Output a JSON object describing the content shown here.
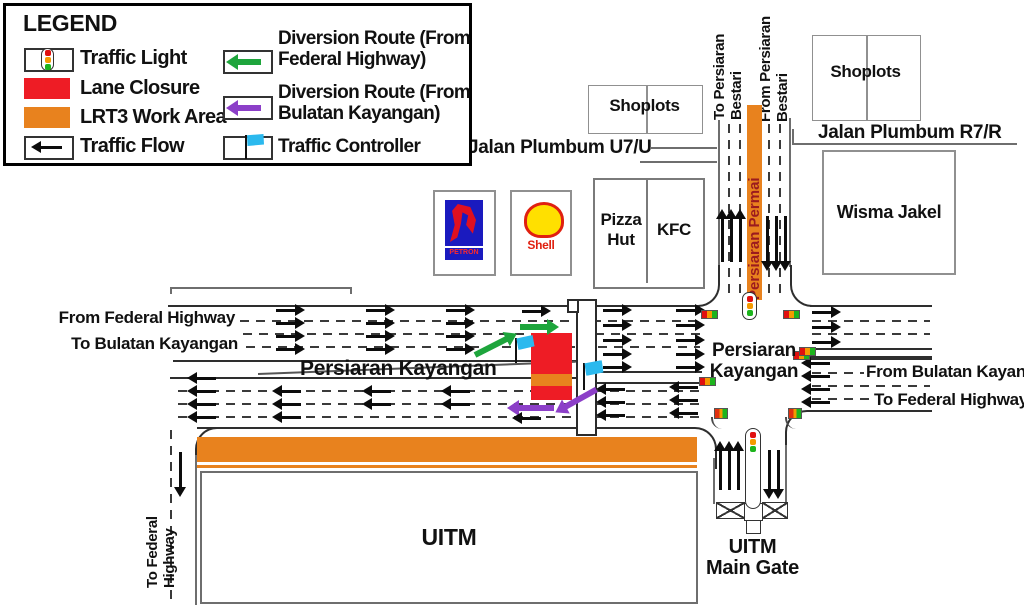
{
  "legend": {
    "title": "LEGEND",
    "items": [
      {
        "id": "traffic-light",
        "label": "Traffic Light"
      },
      {
        "id": "lane-closure",
        "label": "Lane Closure",
        "color": "#EE1C25"
      },
      {
        "id": "lrt3-work-area",
        "label": "LRT3 Work Area",
        "color": "#E8821E"
      },
      {
        "id": "traffic-flow",
        "label": "Traffic Flow",
        "color": "#0C0C0C"
      },
      {
        "id": "diversion-route-federal",
        "label": "Diversion Route (From Federal Highway)",
        "color": "#1EA53C"
      },
      {
        "id": "diversion-route-bulatan",
        "label": "Diversion Route (From Bulatan Kayangan)",
        "color": "#8C3FC8"
      },
      {
        "id": "traffic-controller",
        "label": "Traffic Controller",
        "color": "#2BB9EE"
      }
    ]
  },
  "places": {
    "shoplots": "Shoplots",
    "wisma_jakel": "Wisma Jakel",
    "pizza_hut": "Pizza Hut",
    "kfc": "KFC",
    "petron": "PETRON",
    "shell": "Shell",
    "uitm": "UITM",
    "uitm_main_gate": {
      "line1": "UITM",
      "line2": "Main Gate"
    }
  },
  "roads": {
    "jalan_plumbum_u7u": "Jalan Plumbum U7/U",
    "jalan_plumbum_r7r": "Jalan Plumbum R7/R",
    "persiaran_kayangan": "Persiaran Kayangan",
    "persiaran_kayangan_east": {
      "line1": "Persiaran",
      "line2": "Kayangan"
    },
    "persiaran_permai": "Persiaran Permai",
    "to_persiaran_bestari": {
      "line1": "To Persiaran",
      "line2": "Bestari"
    },
    "from_persiaran_bestari": {
      "line1": "From Persiaran",
      "line2": "Bestari"
    },
    "from_federal_highway": "From Federal Highway",
    "to_bulatan_kayangan": "To Bulatan Kayangan",
    "from_bulatan_kayangan": "From Bulatan Kayangan",
    "to_federal_highway": "To Federal Highway",
    "to_federal_highway_south": {
      "line1": "To Federal",
      "line2": "Highway"
    }
  },
  "colors": {
    "work_area": "#E8821E",
    "lane_closure": "#EE1C25",
    "diversion_federal": "#1EA53C",
    "diversion_bulatan": "#8C3FC8",
    "controller_flag": "#2BB9EE",
    "permai_text": "#9B1B1E"
  }
}
